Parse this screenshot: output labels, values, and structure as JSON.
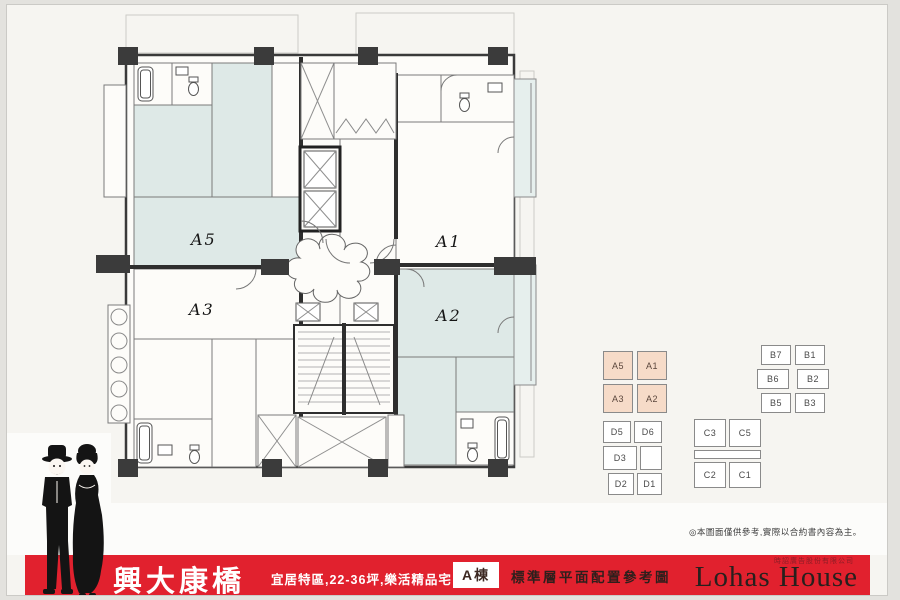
{
  "plan": {
    "unit_labels": [
      "A5",
      "A1",
      "A3",
      "A2"
    ]
  },
  "keyplans": {
    "a_cells": [
      "A5",
      "A1",
      "A3",
      "A2"
    ],
    "b_cells": [
      "B7",
      "B1",
      "B6",
      "B2",
      "B5",
      "B3"
    ],
    "d_cells": [
      "D5",
      "D6",
      "D3",
      "D2",
      "D1"
    ],
    "c_cells": [
      "C3",
      "C5",
      "C2",
      "C1"
    ]
  },
  "disclaimer": "◎本圖面僅供參考,實際以合約書內容為主。",
  "banner": {
    "project_name": "興大康橋",
    "tagline": "宜居特區,22-36坪,樂活精品宅",
    "building_badge": "A棟",
    "plan_title": "標準層平面配置參考圖",
    "brand": "Lohas House",
    "agency": "時詔廣告股份有限公司"
  },
  "colors": {
    "banner_red": "#e1212e",
    "room_tint": "#dee9e7",
    "keyplan_peach": "#f6dbc8",
    "wall_dark": "#2e2e2e"
  }
}
